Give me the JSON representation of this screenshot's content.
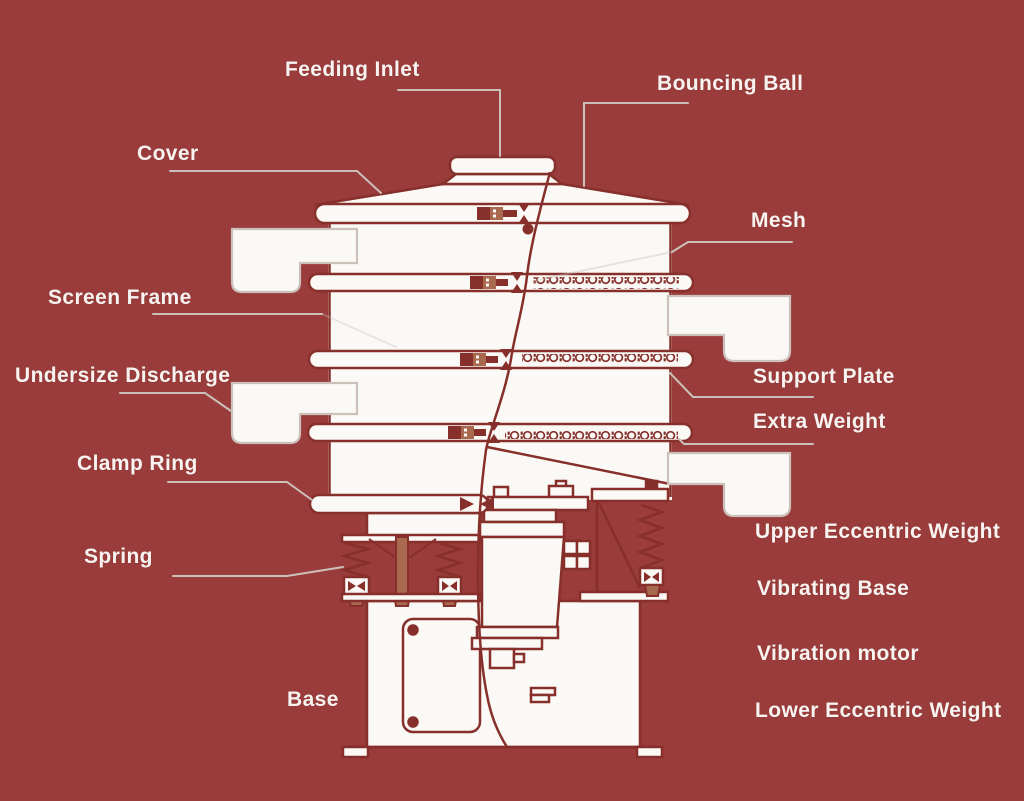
{
  "diagram_title": "Vibrating sieve machine cutaway parts diagram",
  "colors": {
    "background": "#993c3b",
    "drawing_line": "#862f2b",
    "drawing_fill": "#fbf9f6",
    "leader_line": "#ccc0ba",
    "accent_tan": "#a8694e",
    "label_text": "#f7f3f0"
  },
  "labels": [
    {
      "id": "feeding-inlet",
      "text": "Feeding Inlet"
    },
    {
      "id": "bouncing-ball",
      "text": "Bouncing Ball"
    },
    {
      "id": "cover",
      "text": "Cover"
    },
    {
      "id": "mesh",
      "text": "Mesh"
    },
    {
      "id": "screen-frame",
      "text": "Screen Frame"
    },
    {
      "id": "support-plate",
      "text": "Support Plate"
    },
    {
      "id": "undersize-discharge",
      "text": "Undersize Discharge"
    },
    {
      "id": "extra-weight",
      "text": "Extra Weight"
    },
    {
      "id": "clamp-ring",
      "text": "Clamp Ring"
    },
    {
      "id": "upper-eccentric-weight",
      "text": "Upper Eccentric Weight"
    },
    {
      "id": "spring",
      "text": "Spring"
    },
    {
      "id": "vibrating-base",
      "text": "Vibrating Base"
    },
    {
      "id": "vibration-motor",
      "text": "Vibration motor"
    },
    {
      "id": "base",
      "text": "Base"
    },
    {
      "id": "lower-eccentric-weight",
      "text": "Lower Eccentric Weight"
    }
  ]
}
